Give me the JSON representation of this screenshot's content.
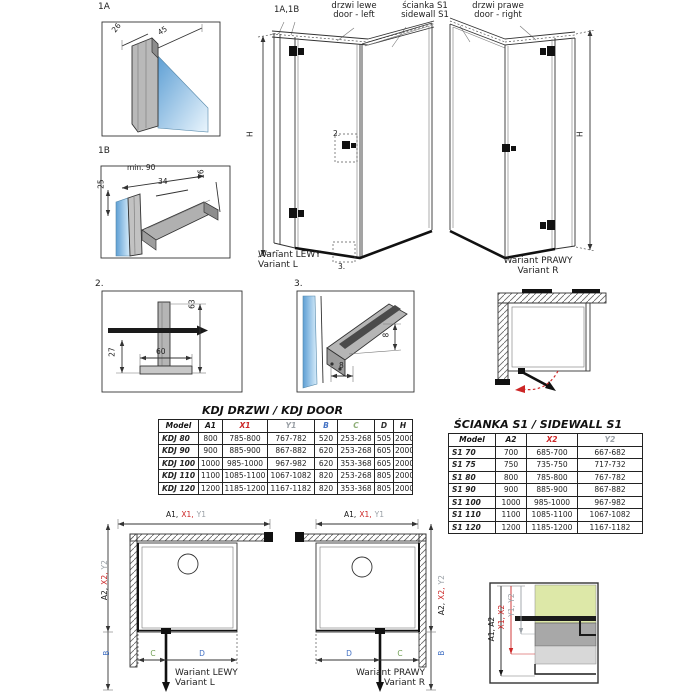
{
  "colors": {
    "accent_red": "#cc2626",
    "accent_blue": "#4472c4",
    "accent_gray": "#9aa0a6",
    "accent_green": "#6f9e52",
    "line_black": "#1a1a1a",
    "glass_blue": "#5e9fd4",
    "glass_green": "#dde8a8"
  },
  "detail_1a": {
    "ref": "1A",
    "dim_26": "26",
    "dim_45": "45"
  },
  "detail_1b": {
    "ref": "1B",
    "dim_min90": "min. 90",
    "dim_25": "25",
    "dim_34": "34",
    "dim_16": "16"
  },
  "detail_2": {
    "ref": "2.",
    "dim_63": "63",
    "dim_27": "27",
    "dim_60": "60"
  },
  "detail_3": {
    "ref": "3.",
    "dim_8_right": "8",
    "dim_8_bottom": "8"
  },
  "iso": {
    "ref_1a1b": "1A,1B",
    "door_left": {
      "pl": "drzwi lewe",
      "en": "door - left"
    },
    "sidewall": {
      "pl": "ścianka S1",
      "en": "sidewall S1"
    },
    "door_right": {
      "pl": "drzwi prawe",
      "en": "door - right"
    },
    "h_dim_left": "H",
    "h_dim_right": "H",
    "ref_2": "2.",
    "ref_3": "3.",
    "variant_left": {
      "pl": "Wariant LEWY",
      "en": "Variant L"
    },
    "variant_right": {
      "pl": "Wariant PRAWY",
      "en": "Variant R"
    }
  },
  "door_table": {
    "title": "KDJ DRZWI / KDJ DOOR",
    "headers": [
      "Model",
      "A1",
      "X1",
      "Y1",
      "B",
      "C",
      "D",
      "H"
    ],
    "header_colors": [
      "#111111",
      "#1a1a1a",
      "#cc2626",
      "#9aa0a6",
      "#4472c4",
      "#8fae77",
      "#333333",
      "#1a1a1a"
    ],
    "rows": [
      [
        "KDJ 80",
        "800",
        "785-800",
        "767-782",
        "520",
        "253-268",
        "505",
        "2000"
      ],
      [
        "KDJ 90",
        "900",
        "885-900",
        "867-882",
        "620",
        "253-268",
        "605",
        "2000"
      ],
      [
        "KDJ 100",
        "1000",
        "985-1000",
        "967-982",
        "620",
        "353-368",
        "605",
        "2000"
      ],
      [
        "KDJ 110",
        "1100",
        "1085-1100",
        "1067-1082",
        "820",
        "253-268",
        "805",
        "2000"
      ],
      [
        "KDJ 120",
        "1200",
        "1185-1200",
        "1167-1182",
        "820",
        "353-368",
        "805",
        "2000"
      ]
    ]
  },
  "sidewall_table": {
    "title": "ŚCIANKA S1 / SIDEWALL S1",
    "headers": [
      "Model",
      "A2",
      "X2",
      "Y2"
    ],
    "header_colors": [
      "#111111",
      "#1a1a1a",
      "#cc2626",
      "#9aa0a6"
    ],
    "rows": [
      [
        "S1 70",
        "700",
        "685-700",
        "667-682"
      ],
      [
        "S1 75",
        "750",
        "735-750",
        "717-732"
      ],
      [
        "S1 80",
        "800",
        "785-800",
        "767-782"
      ],
      [
        "S1 90",
        "900",
        "885-900",
        "867-882"
      ],
      [
        "S1 100",
        "1000",
        "985-1000",
        "967-982"
      ],
      [
        "S1 110",
        "1100",
        "1085-1100",
        "1067-1082"
      ],
      [
        "S1 120",
        "1200",
        "1185-1200",
        "1167-1182"
      ]
    ]
  },
  "plan": {
    "dim_a1": "A1,",
    "dim_x1": "X1,",
    "dim_y1": "Y1",
    "dim_a2": "A2,",
    "dim_x2": "X2,",
    "dim_y2": "Y2",
    "dim_b": "B",
    "dim_c": "C",
    "dim_d": "D",
    "variant_left": {
      "pl": "Wariant LEWY",
      "en": "Variant L"
    },
    "variant_right": {
      "pl": "Wariant PRAWY",
      "en": "Variant R"
    }
  },
  "corner_detail": {
    "dim_a": "A1, A2",
    "dim_x": "X1, X2",
    "dim_y": "Y1, Y2"
  }
}
